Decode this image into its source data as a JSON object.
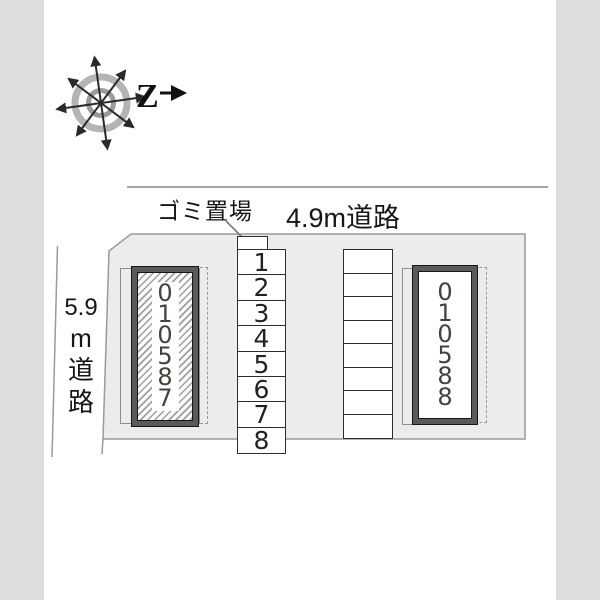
{
  "compass": {
    "north_label": "Z"
  },
  "labels": {
    "garbage_area": "ゴミ置場",
    "top_road": "4.9m道路",
    "left_road_lines": [
      "5.9",
      "m",
      "道",
      "路"
    ]
  },
  "buildings": {
    "left": {
      "number": "010587",
      "hatched": true
    },
    "right": {
      "number": "010588",
      "hatched": false
    }
  },
  "parking": {
    "numbered": [
      "1",
      "2",
      "3",
      "4",
      "5",
      "6",
      "7",
      "8"
    ],
    "unnumbered_count": 8
  },
  "colors": {
    "page_margin": "#dedede",
    "site_fill": "#ececec",
    "outline_gray": "#9a9a9a",
    "road_line": "#a6a6a6",
    "cell_border": "#2e2e2e",
    "building_frame": "#5a5a5a",
    "building_digits": "#46413a",
    "text_dark": "#161616"
  }
}
